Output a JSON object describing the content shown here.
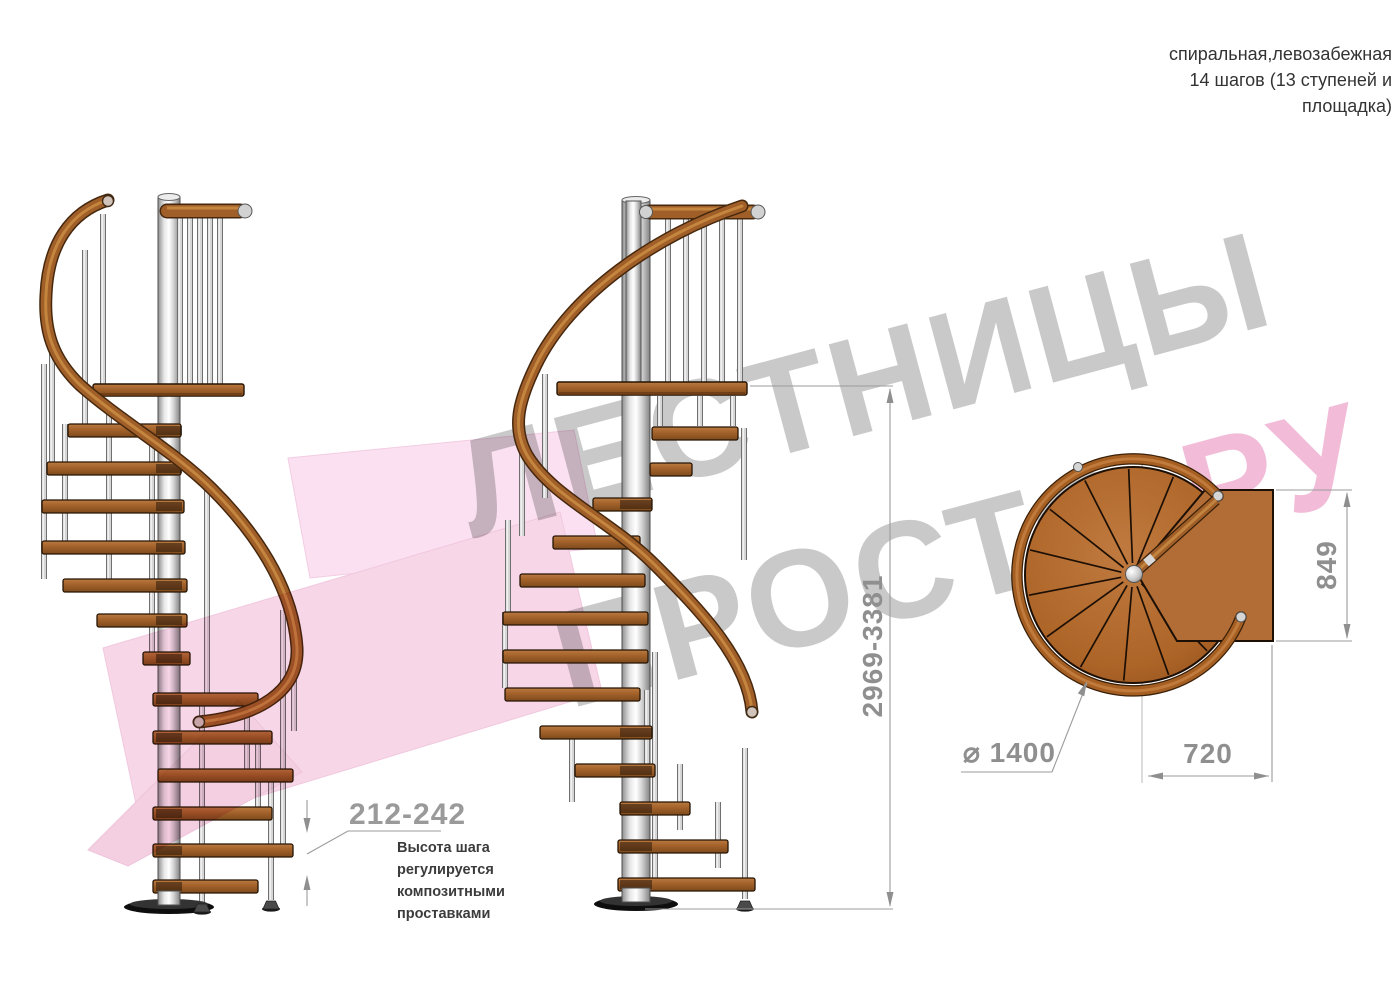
{
  "header": {
    "line1": "спиральная,левозабежная",
    "line2": "14 шагов (13 ступеней и",
    "line3": "площадка)"
  },
  "note": {
    "line1": "Высота шага",
    "line2": "регулируется",
    "line3": "композитными",
    "line4": "проставками"
  },
  "dimensions": {
    "total_height": "2969-3381",
    "step_height": "212-242",
    "platform_depth": "849",
    "platform_width": "720",
    "diameter": "⌀ 1400"
  },
  "watermark": {
    "word1": "ЛЕСТНИЦЫ",
    "word2": "ПРОСТО",
    "word3": ".РУ"
  },
  "colors": {
    "wood_step": "#a5612a",
    "wood_step_light": "#bb7a40",
    "wood_step_dark": "#7e4a1c",
    "handrail": "#a05f28",
    "handrail_outline": "#46280e",
    "handrail_highlight": "#cd9045",
    "metal_light": "#f2f2f2",
    "metal_mid": "#d6d6d6",
    "metal_dark": "#777777",
    "top_view_wood": "#ad6427",
    "dimension_gray": "#8f8f8f",
    "watermark_gray": "#c9c9c9",
    "watermark_pink": "#f2bcd8",
    "arrow_pink": "#f5cce3"
  }
}
